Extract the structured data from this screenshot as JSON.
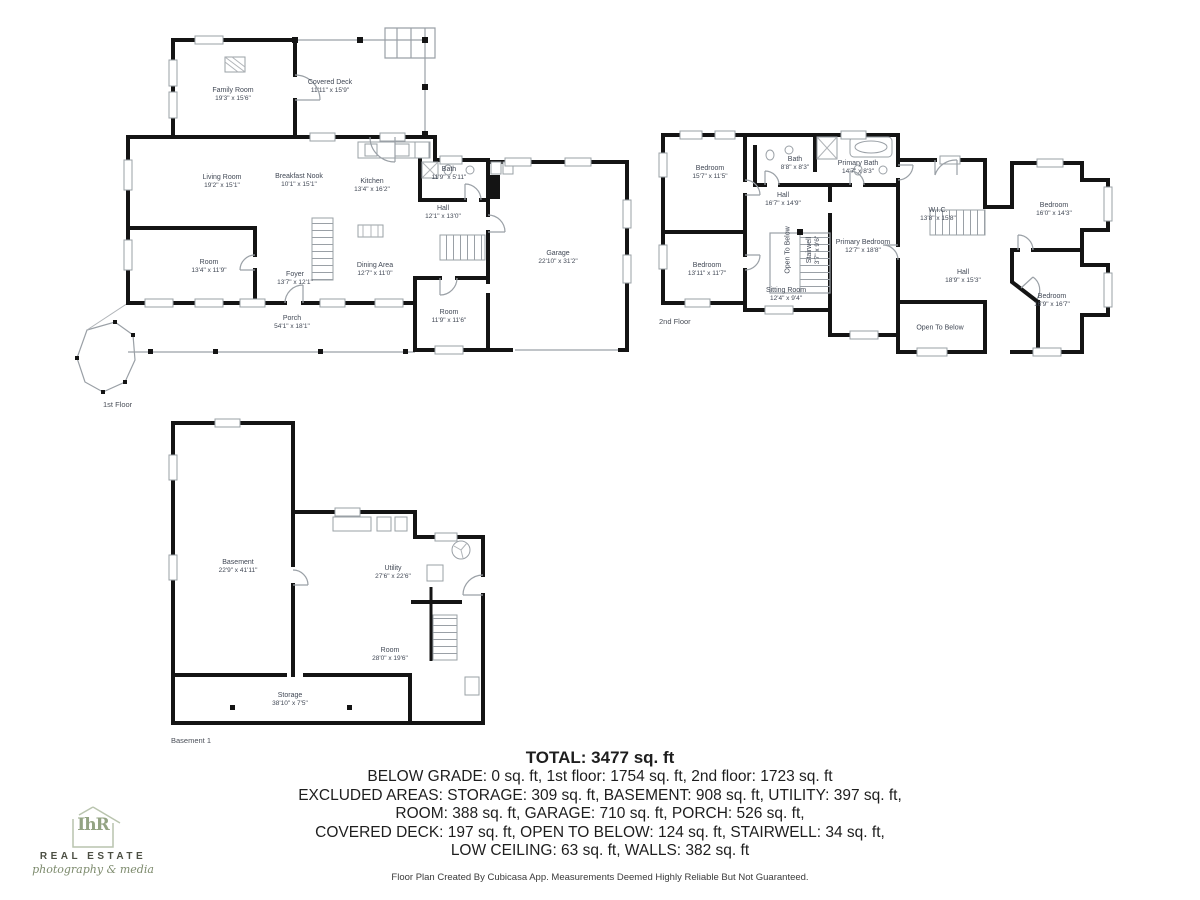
{
  "document": {
    "type": "floor-plan-sheet"
  },
  "floors": [
    {
      "id": "floor-1",
      "label": "1st Floor",
      "rooms": [
        {
          "name": "Family Room",
          "dims": "19'3\" x 15'6\"",
          "x": 233,
          "y": 95
        },
        {
          "name": "Covered Deck",
          "dims": "11'11\" x 15'9\"",
          "x": 330,
          "y": 87
        },
        {
          "name": "Living Room",
          "dims": "19'2\" x 15'1\"",
          "x": 222,
          "y": 182
        },
        {
          "name": "Breakfast Nook",
          "dims": "10'1\" x 15'1\"",
          "x": 299,
          "y": 181
        },
        {
          "name": "Kitchen",
          "dims": "13'4\" x 16'2\"",
          "x": 372,
          "y": 186
        },
        {
          "name": "Bath",
          "dims": "11'9\" x 5'11\"",
          "x": 449,
          "y": 174
        },
        {
          "name": "Hall",
          "dims": "12'1\" x 13'0\"",
          "x": 443,
          "y": 213
        },
        {
          "name": "Room",
          "dims": "13'4\" x 11'9\"",
          "x": 209,
          "y": 267
        },
        {
          "name": "Foyer",
          "dims": "13'7\" x 12'1\"",
          "x": 295,
          "y": 279
        },
        {
          "name": "Dining Area",
          "dims": "12'7\" x 11'0\"",
          "x": 375,
          "y": 270
        },
        {
          "name": "Garage",
          "dims": "22'10\" x 31'2\"",
          "x": 558,
          "y": 258
        },
        {
          "name": "Room",
          "dims": "11'9\" x 11'6\"",
          "x": 449,
          "y": 317
        },
        {
          "name": "Porch",
          "dims": "54'1\" x 18'1\"",
          "x": 292,
          "y": 323
        }
      ]
    },
    {
      "id": "floor-2",
      "label": "2nd Floor",
      "rooms": [
        {
          "name": "Bedroom",
          "dims": "15'7\" x 11'5\"",
          "x": 710,
          "y": 173
        },
        {
          "name": "Bath",
          "dims": "8'8\" x 8'3\"",
          "x": 795,
          "y": 164
        },
        {
          "name": "Primary Bath",
          "dims": "14'7\" x 8'3\"",
          "x": 858,
          "y": 168
        },
        {
          "name": "Hall",
          "dims": "16'7\" x 14'9\"",
          "x": 783,
          "y": 200
        },
        {
          "name": "Bedroom",
          "dims": "13'11\" x 11'7\"",
          "x": 707,
          "y": 270
        },
        {
          "name": "Open To Below",
          "dims": "",
          "x": 788,
          "y": 250,
          "vertical": true
        },
        {
          "name": "Stairwell",
          "dims": "3'7\" x 9'6\"",
          "x": 814,
          "y": 250,
          "vertical": true
        },
        {
          "name": "Primary Bedroom",
          "dims": "12'7\" x 18'8\"",
          "x": 863,
          "y": 247
        },
        {
          "name": "Sitting Room",
          "dims": "12'4\" x 9'4\"",
          "x": 786,
          "y": 295
        },
        {
          "name": "W.I.C.",
          "dims": "13'8\" x 15'8\"",
          "x": 938,
          "y": 215
        },
        {
          "name": "Hall",
          "dims": "18'9\" x 15'3\"",
          "x": 963,
          "y": 277
        },
        {
          "name": "Bedroom",
          "dims": "16'0\" x 14'3\"",
          "x": 1054,
          "y": 210
        },
        {
          "name": "Bedroom",
          "dims": "16'9\" x 16'7\"",
          "x": 1052,
          "y": 301
        },
        {
          "name": "Open To Below",
          "dims": "",
          "x": 940,
          "y": 328
        }
      ]
    },
    {
      "id": "basement",
      "label": "Basement 1",
      "rooms": [
        {
          "name": "Basement",
          "dims": "22'9\" x 41'11\"",
          "x": 238,
          "y": 567
        },
        {
          "name": "Utility",
          "dims": "27'6\" x 22'6\"",
          "x": 393,
          "y": 573
        },
        {
          "name": "Room",
          "dims": "28'0\" x 19'6\"",
          "x": 390,
          "y": 655
        },
        {
          "name": "Storage",
          "dims": "38'10\" x 7'5\"",
          "x": 290,
          "y": 700
        }
      ]
    }
  ],
  "summary": {
    "total": "TOTAL: 3477 sq. ft",
    "lines": [
      "BELOW GRADE: 0 sq. ft, 1st floor: 1754 sq. ft, 2nd floor: 1723 sq. ft",
      "EXCLUDED AREAS: STORAGE: 309 sq. ft, BASEMENT: 908 sq. ft, UTILITY: 397 sq. ft,",
      "ROOM: 388 sq. ft, GARAGE: 710 sq. ft, PORCH: 526 sq. ft,",
      "COVERED DECK: 197 sq. ft, OPEN TO BELOW: 124 sq. ft, STAIRWELL: 34 sq. ft,",
      "LOW CEILING: 63 sq. ft, WALLS: 382 sq. ft"
    ]
  },
  "footer": "Floor Plan Created By Cubicasa App. Measurements Deemed Highly Reliable But Not Guaranteed.",
  "logo": {
    "monogram": "IhR",
    "line1": "REAL ESTATE",
    "line2": "photography & media"
  },
  "colors": {
    "wall": "#141414",
    "thin_line": "#9aa0a6",
    "label_text": "#414855",
    "logo_green": "#93a383"
  }
}
